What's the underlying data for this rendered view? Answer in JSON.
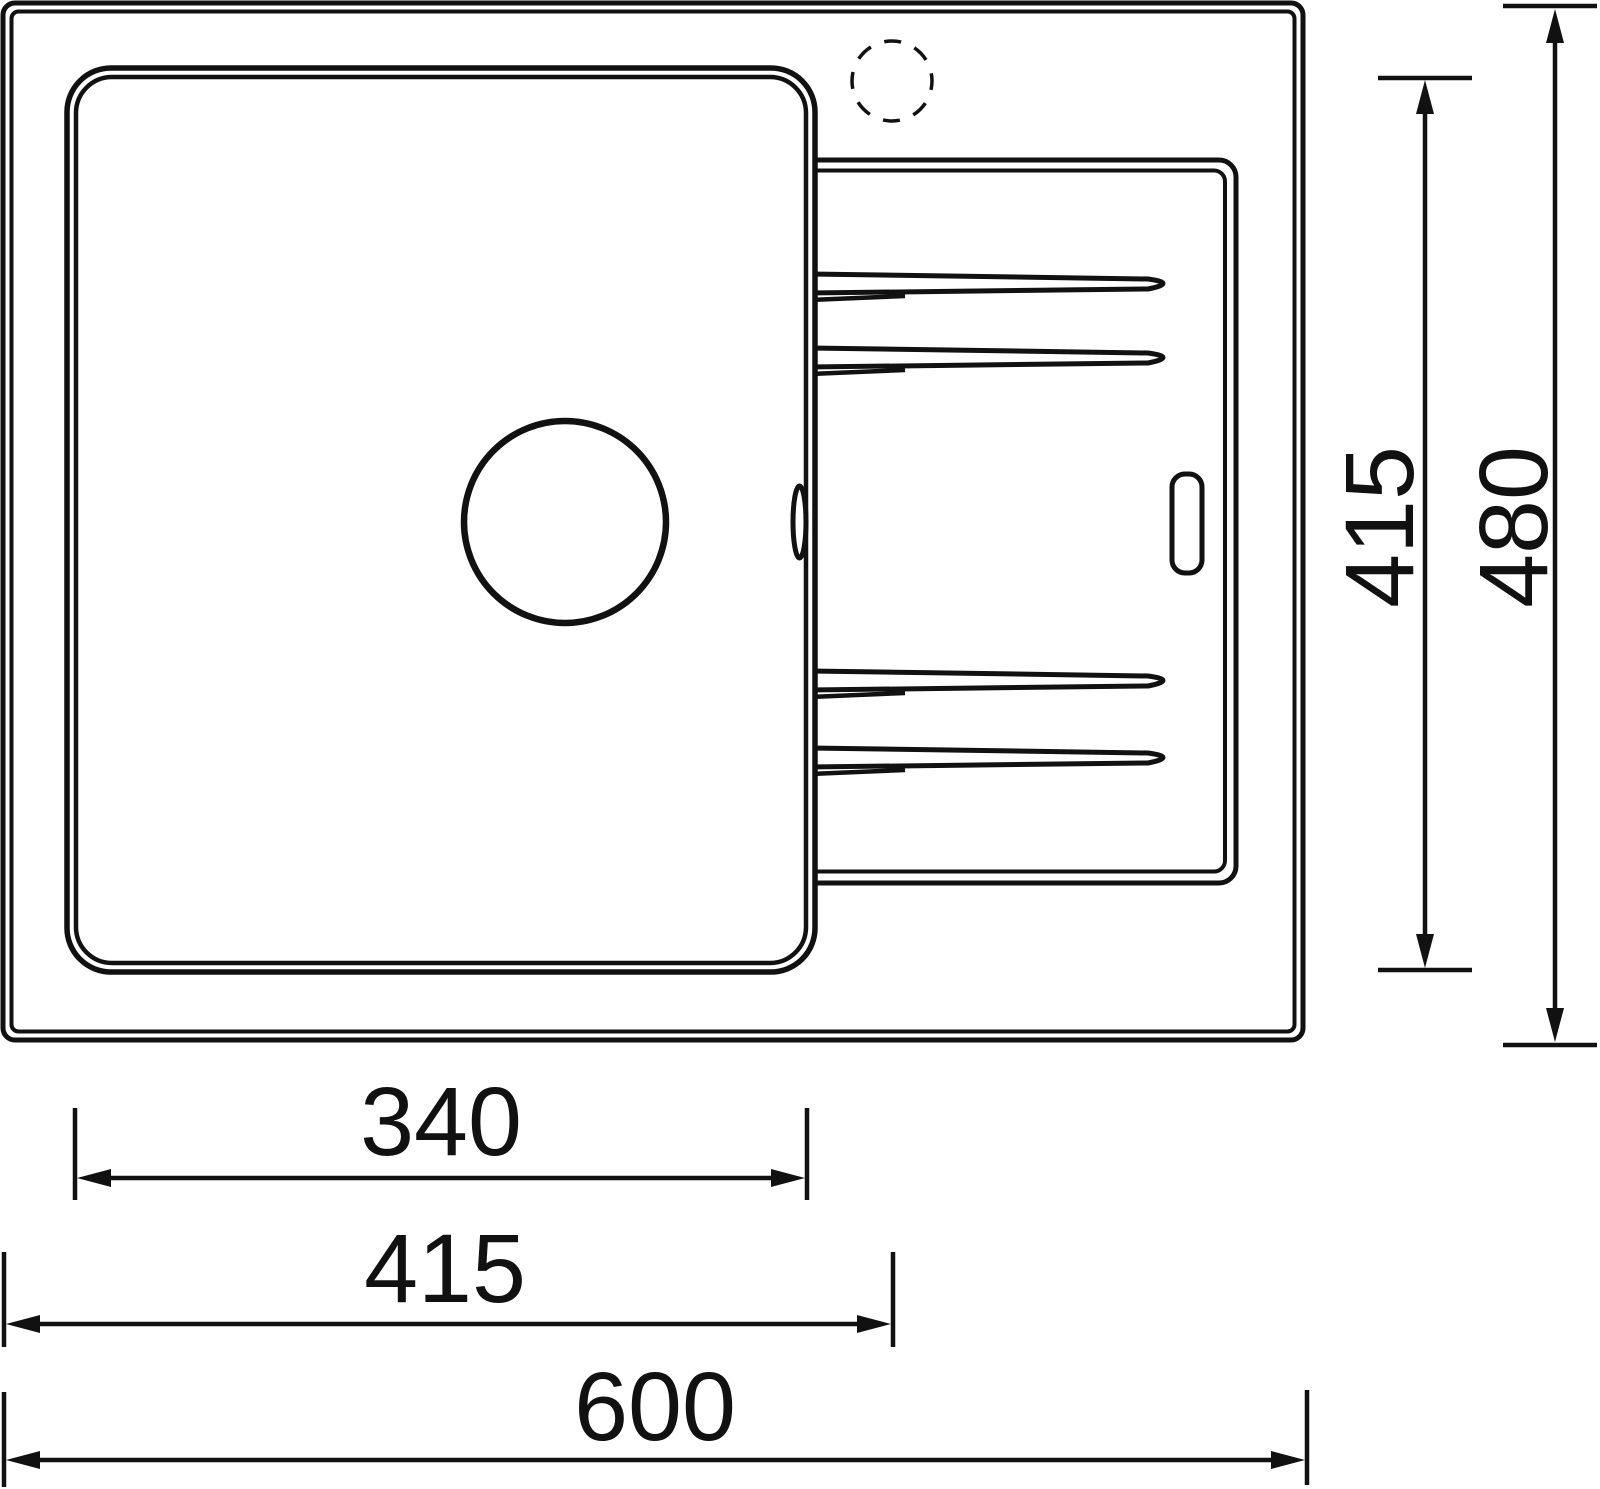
{
  "drawing": {
    "subject": "kitchen-sink-top-view-technical-drawing",
    "background": "#ffffff",
    "line_color": "#111111",
    "dimensions": {
      "bowl_width": "340",
      "left_to_tap_center": "415",
      "overall_width": "600",
      "bowl_depth": "415",
      "overall_depth": "480"
    }
  }
}
